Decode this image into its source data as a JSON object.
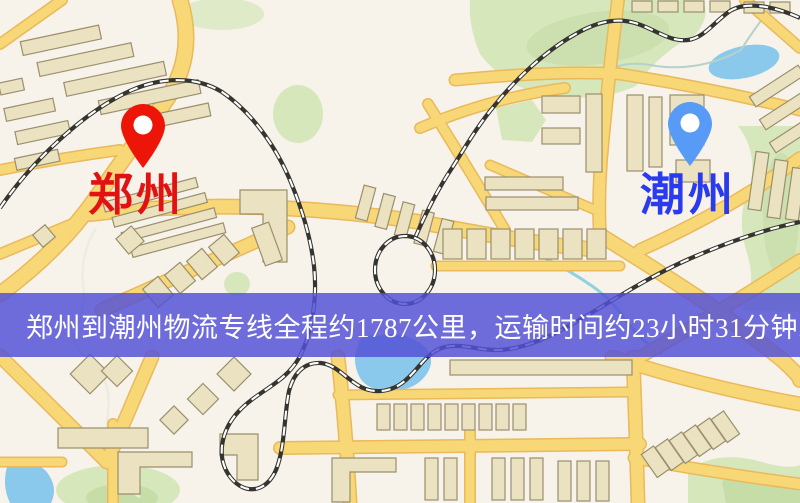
{
  "map": {
    "origin": {
      "label": "郑州"
    },
    "destination": {
      "label": "潮州"
    },
    "banner": {
      "text": "郑州到潮州物流专线全程约1787公里，运输时间约23小时31分钟."
    },
    "route": {
      "distance_text": "约1787公里",
      "duration_text": "约23小时31分钟"
    },
    "colors": {
      "origin_label": "#e31212",
      "destination_label": "#2a3bee",
      "origin_pin": "#ec1507",
      "destination_pin": "#579bf7",
      "banner_bg": "rgba(83,81,215,0.84)",
      "banner_text": "#ffffff"
    }
  }
}
